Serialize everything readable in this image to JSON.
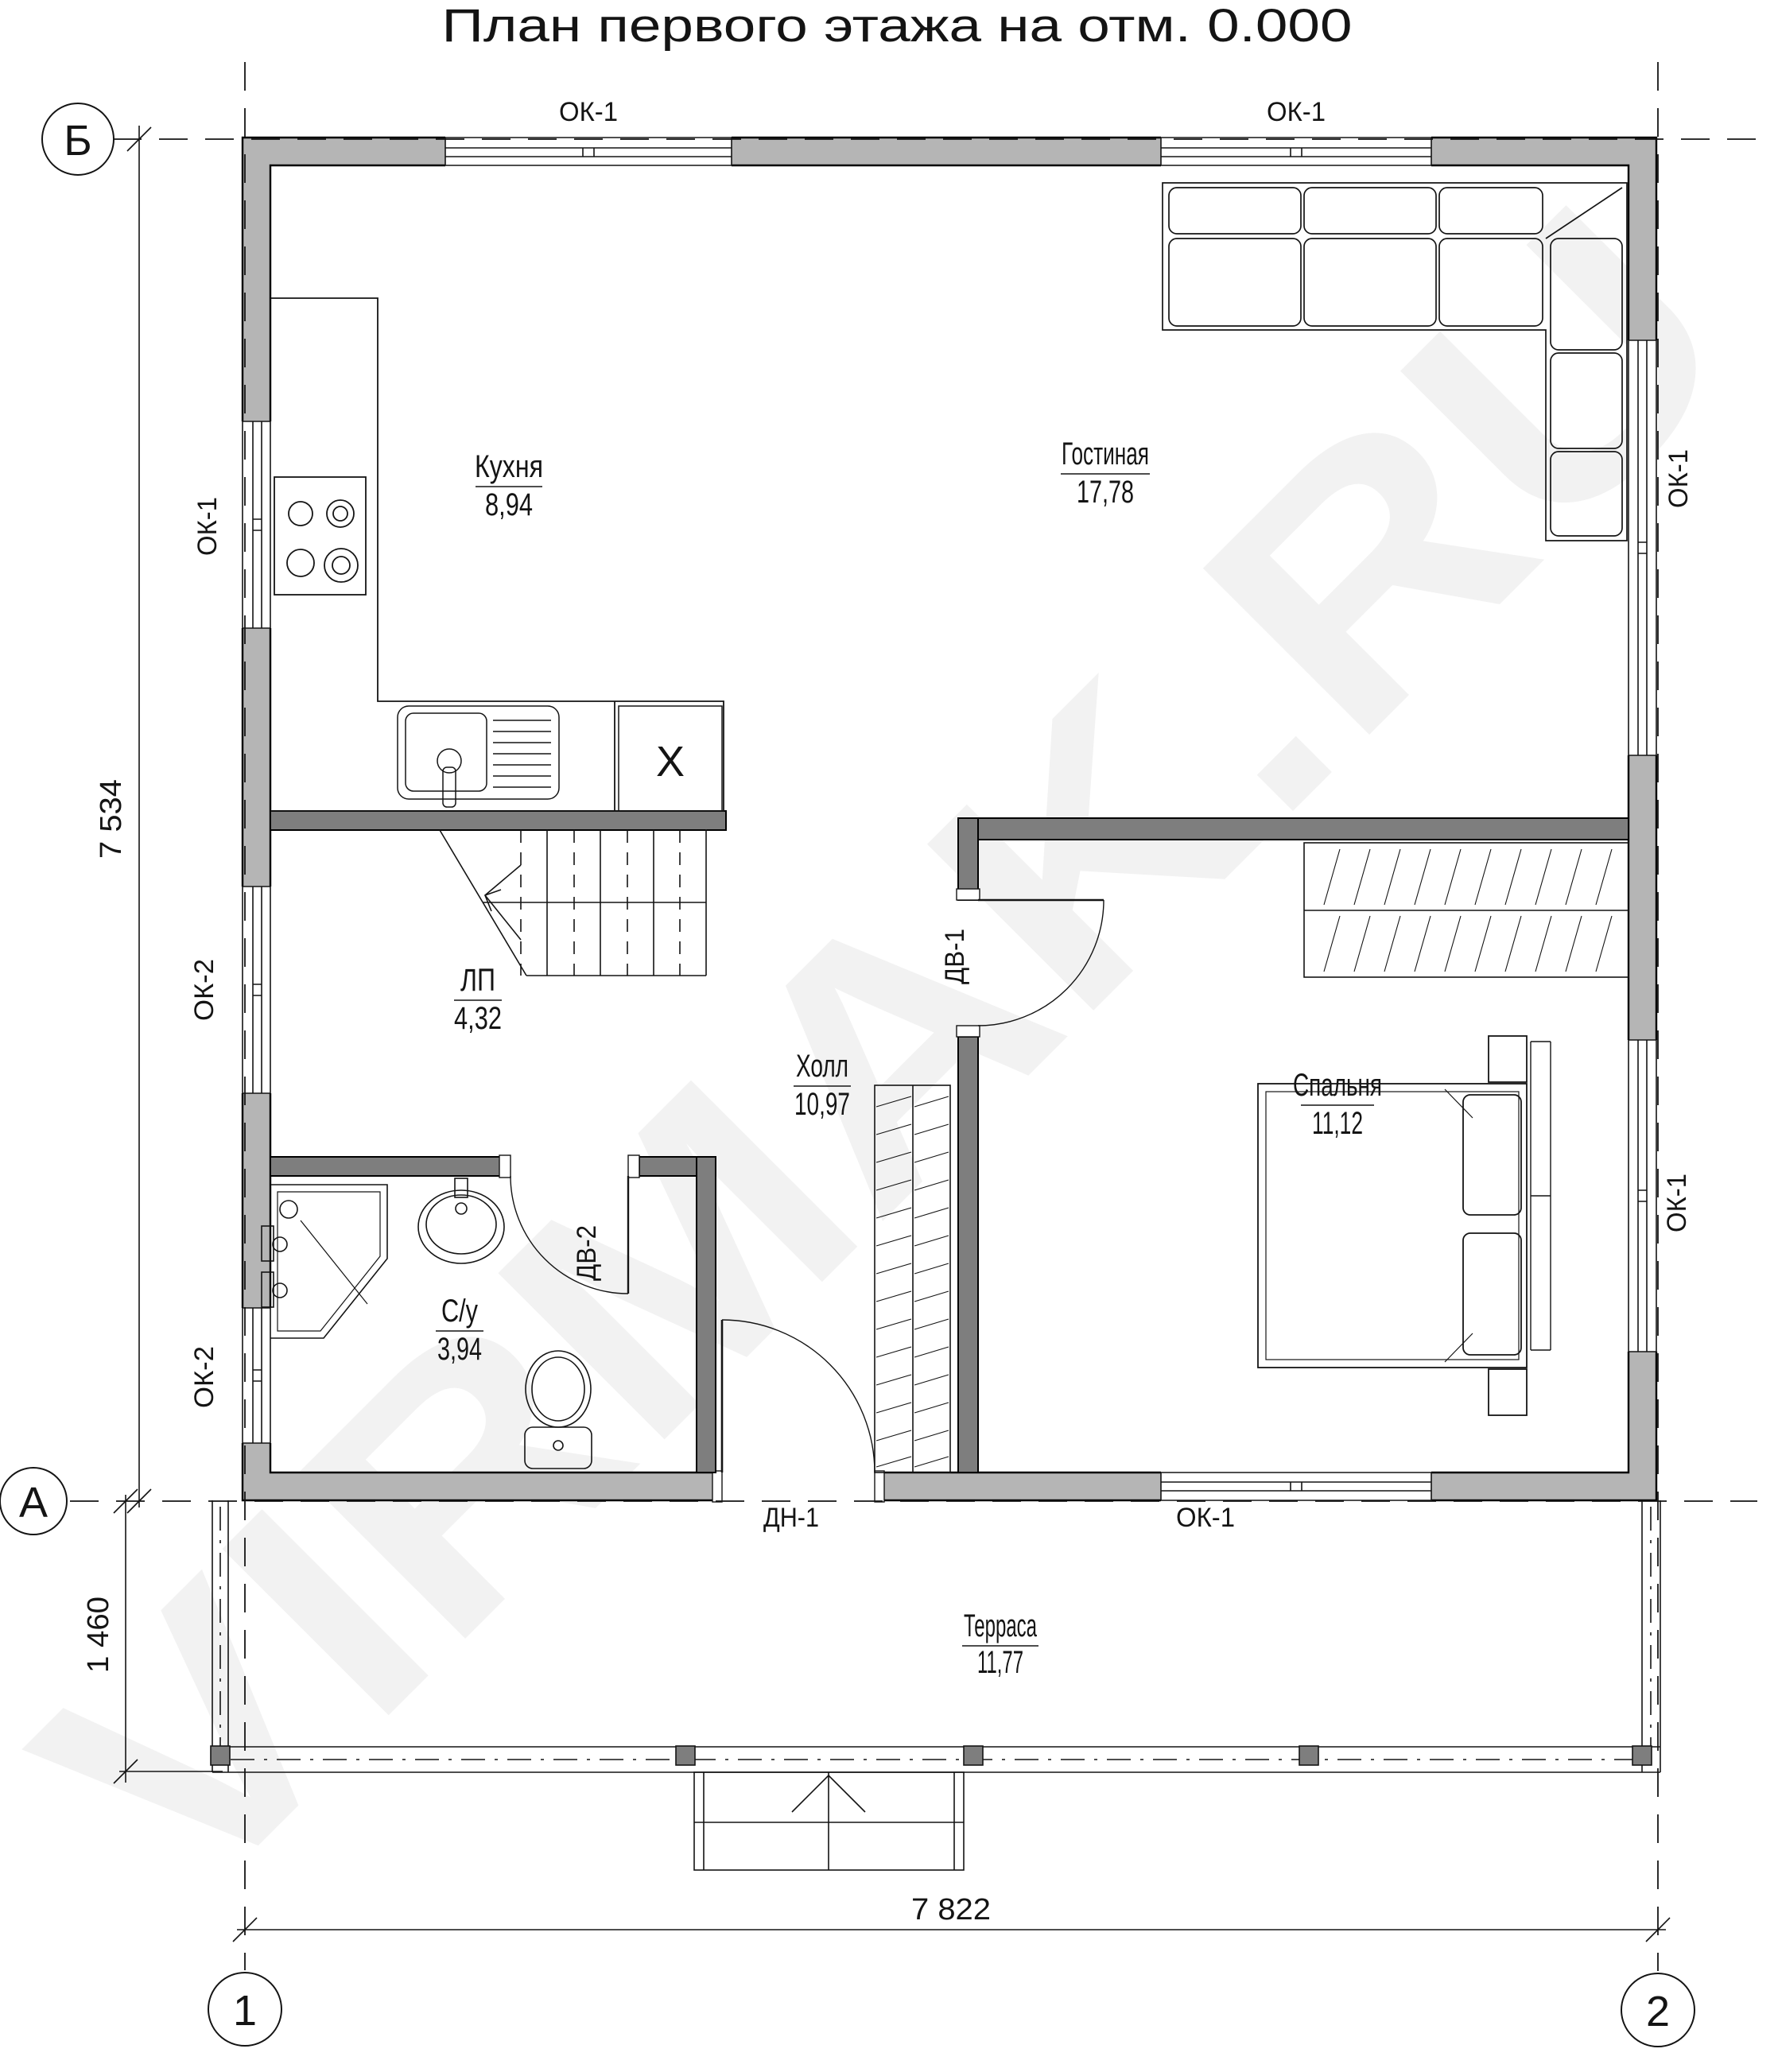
{
  "title": "План первого этажа на отм. 0.000",
  "watermark": "VIRMAK.RU",
  "axes": {
    "b": "Б",
    "a": "А",
    "n1": "1",
    "n2": "2"
  },
  "dimensions": {
    "left_main": "7 534",
    "left_terrace": "1 460",
    "bottom_total": "7 822"
  },
  "openings": {
    "ok1": "ОК-1",
    "ok2": "ОК-2",
    "dv1": "ДВ-1",
    "dv2": "ДВ-2",
    "dn1": "ДН-1"
  },
  "rooms": {
    "kitchen": {
      "name": "Кухня",
      "area": "8,94"
    },
    "living": {
      "name": "Гостиная",
      "area": "17,78"
    },
    "stairs": {
      "name": "ЛП",
      "area": "4,32"
    },
    "hall": {
      "name": "Холл",
      "area": "10,97"
    },
    "wc": {
      "name": "С/у",
      "area": "3,94"
    },
    "bedroom": {
      "name": "Спальня",
      "area": "11,12"
    },
    "terrace": {
      "name": "Терраса",
      "area": "11,77"
    }
  },
  "fixtures": {
    "washing_machine_mark": "X"
  },
  "colors": {
    "outer_wall": "#b5b5b5",
    "partition": "#7e7e7e",
    "line": "#141414"
  }
}
